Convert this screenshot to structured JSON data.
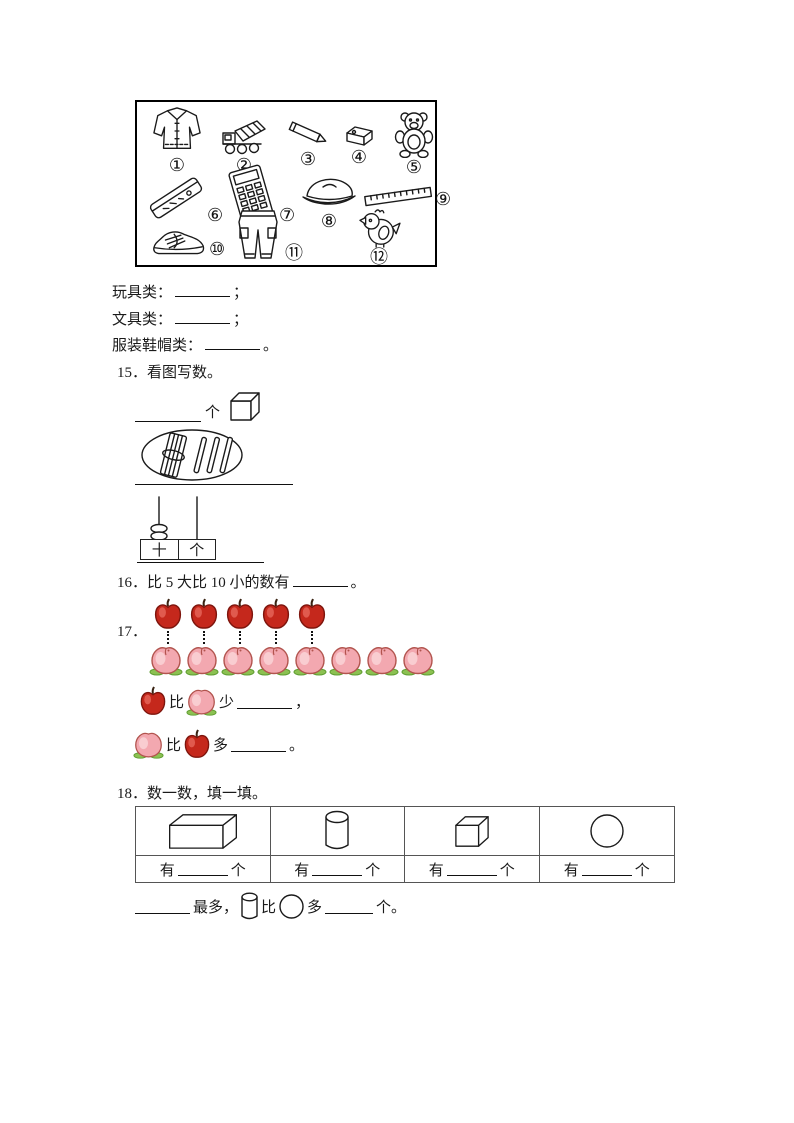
{
  "box": {
    "items": [
      {
        "number": "①",
        "name": "jacket"
      },
      {
        "number": "②",
        "name": "toy-truck"
      },
      {
        "number": "③",
        "name": "pencil"
      },
      {
        "number": "④",
        "name": "eraser"
      },
      {
        "number": "⑤",
        "name": "teddy-bear"
      },
      {
        "number": "⑥",
        "name": "pencil-case"
      },
      {
        "number": "⑦",
        "name": "calculator"
      },
      {
        "number": "⑧",
        "name": "cap"
      },
      {
        "number": "⑨",
        "name": "ruler"
      },
      {
        "number": "⑩",
        "name": "shoe"
      },
      {
        "number": "⑪",
        "name": "pants"
      },
      {
        "number": "⑫",
        "name": "toy-chick"
      }
    ]
  },
  "categories": [
    {
      "label": "玩具类：",
      "suffix": "；"
    },
    {
      "label": "文具类：",
      "suffix": "；"
    },
    {
      "label": "服装鞋帽类：",
      "suffix": "。"
    }
  ],
  "q15": {
    "number": "15．",
    "title": "看图写数。",
    "unit": "个",
    "sticks": {
      "bundles_of_ten": 1,
      "single_sticks": 3
    },
    "abacus": {
      "tens_label": "十",
      "ones_label": "个",
      "tens_beads": 2,
      "ones_beads": 0
    }
  },
  "q16": {
    "number": "16．",
    "text": "比 5 大比 10 小的数有",
    "suffix": "。"
  },
  "q17": {
    "number": "17．",
    "apple_count": 5,
    "peach_count": 8,
    "sentence1": {
      "bi": "比",
      "verb": "少",
      "suffix": "，"
    },
    "sentence2": {
      "bi": "比",
      "verb": "多",
      "suffix": "。"
    }
  },
  "q18": {
    "number": "18．",
    "title": "数一数，填一填。",
    "shapes": [
      "cuboid",
      "cylinder",
      "cube",
      "circle"
    ],
    "cell_prefix": "有",
    "cell_suffix": "个",
    "final": {
      "most": "最多，",
      "bi": "比",
      "duo": "多",
      "suffix": "个。"
    }
  },
  "colors": {
    "apple_red": "#c5281c",
    "apple_highlight": "#e05a4e",
    "peach_pink": "#f3a8b0",
    "peach_light": "#f9cdd1",
    "peach_outline": "#b2544e",
    "leaf_green": "#8cc152",
    "ink": "#1a1a1a"
  }
}
